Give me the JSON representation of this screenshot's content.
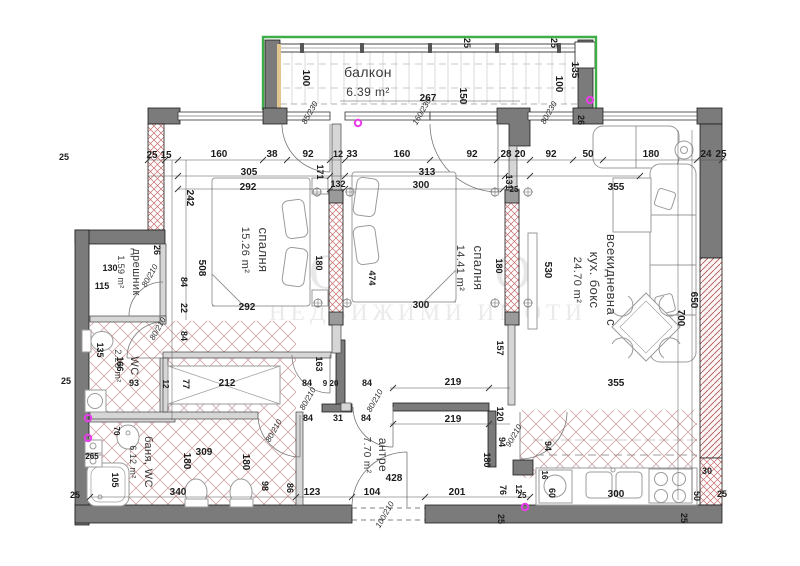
{
  "watermark": {
    "line1": "О М О",
    "line2": "НЕДВИЖИМИ ИМОТИ"
  },
  "rooms": [
    {
      "name": "балкон",
      "area": "6.39 m²"
    },
    {
      "name": "спалня",
      "area": "15.26 m²"
    },
    {
      "name": "спалня",
      "area": "14.41 m²"
    },
    {
      "name": "всекидневна с кух. бокс",
      "area": "24.70 m²"
    },
    {
      "name": "дрешник",
      "area": "1.59 m²"
    },
    {
      "name": "WC",
      "area": "2.28 m²"
    },
    {
      "name": "баня, WC",
      "area": "6.12 m²"
    },
    {
      "name": "антре",
      "area": "7.70 m²"
    }
  ],
  "colors": {
    "wall": "#7b7b7b",
    "hatch": "#c06060",
    "green": "#3fae49",
    "magenta": "#e83de8",
    "furniture": "#9b9b9b"
  },
  "magenta_dots": [
    [
      358,
      123
    ],
    [
      88,
      418
    ],
    [
      88,
      438
    ],
    [
      525,
      507
    ],
    [
      590,
      100
    ]
  ],
  "axis_markers": [
    [
      317,
      192
    ],
    [
      350,
      192
    ],
    [
      318,
      303
    ],
    [
      347,
      303
    ],
    [
      495,
      192
    ],
    [
      528,
      192
    ],
    [
      495,
      303
    ],
    [
      528,
      303
    ]
  ],
  "labels": [
    {
      "t": "балкон",
      "x": 368,
      "y": 77,
      "s": 14,
      "cls": "room"
    },
    {
      "t": "6.39 m²",
      "x": 368,
      "y": 96,
      "s": 12,
      "cls": "room"
    },
    {
      "t": "спалня",
      "x": 259,
      "y": 250,
      "r": 90,
      "s": 13,
      "cls": "room"
    },
    {
      "t": "15.26 m²",
      "x": 242,
      "y": 250,
      "r": 90,
      "s": 11,
      "cls": "room"
    },
    {
      "t": "спалня",
      "x": 474,
      "y": 268,
      "r": 90,
      "s": 13,
      "cls": "room"
    },
    {
      "t": "14.41 m²",
      "x": 457,
      "y": 268,
      "r": 90,
      "s": 11,
      "cls": "room"
    },
    {
      "t": "всекидневна с",
      "x": 607,
      "y": 280,
      "r": 90,
      "s": 13,
      "cls": "room"
    },
    {
      "t": "кух. бокс",
      "x": 590,
      "y": 280,
      "r": 90,
      "s": 13,
      "cls": "room"
    },
    {
      "t": "24.70 m²",
      "x": 574,
      "y": 280,
      "r": 90,
      "s": 11,
      "cls": "room"
    },
    {
      "t": "дрешник",
      "x": 133,
      "y": 272,
      "r": 90,
      "s": 11,
      "cls": "room"
    },
    {
      "t": "1.59 m²",
      "x": 118,
      "y": 272,
      "r": 90,
      "s": 9,
      "cls": "room"
    },
    {
      "t": "WC",
      "x": 131,
      "y": 366,
      "r": 90,
      "s": 11,
      "cls": "room"
    },
    {
      "t": "2.28 m²",
      "x": 115,
      "y": 366,
      "r": 90,
      "s": 9,
      "cls": "room"
    },
    {
      "t": "баня, WC",
      "x": 145,
      "y": 462,
      "r": 90,
      "s": 11,
      "cls": "room"
    },
    {
      "t": "6.12 m²",
      "x": 130,
      "y": 462,
      "r": 90,
      "s": 9,
      "cls": "room"
    },
    {
      "t": "антре",
      "x": 379,
      "y": 455,
      "r": 90,
      "s": 12,
      "cls": "room"
    },
    {
      "t": "7.70 m²",
      "x": 364,
      "y": 455,
      "r": 90,
      "s": 10,
      "cls": "room"
    },
    {
      "t": "25",
      "x": 152,
      "y": 158
    },
    {
      "t": "15",
      "x": 166,
      "y": 158
    },
    {
      "t": "160",
      "x": 219,
      "y": 157
    },
    {
      "t": "38",
      "x": 272,
      "y": 157
    },
    {
      "t": "92",
      "x": 308,
      "y": 157
    },
    {
      "t": "12",
      "x": 338,
      "y": 157,
      "s": 9
    },
    {
      "t": "33",
      "x": 352,
      "y": 157
    },
    {
      "t": "160",
      "x": 402,
      "y": 157
    },
    {
      "t": "92",
      "x": 472,
      "y": 157
    },
    {
      "t": "28",
      "x": 506,
      "y": 157
    },
    {
      "t": "20",
      "x": 520,
      "y": 157
    },
    {
      "t": "92",
      "x": 551,
      "y": 157
    },
    {
      "t": "50",
      "x": 588,
      "y": 157
    },
    {
      "t": "180",
      "x": 651,
      "y": 157
    },
    {
      "t": "24",
      "x": 706,
      "y": 157
    },
    {
      "t": "25",
      "x": 721,
      "y": 157
    },
    {
      "t": "305",
      "x": 249,
      "y": 175
    },
    {
      "t": "313",
      "x": 427,
      "y": 175
    },
    {
      "t": "355",
      "x": 616,
      "y": 190
    },
    {
      "t": "292",
      "x": 248,
      "y": 190
    },
    {
      "t": "300",
      "x": 421,
      "y": 188
    },
    {
      "t": "242",
      "x": 187,
      "y": 198,
      "r": 90
    },
    {
      "t": "171",
      "x": 317,
      "y": 172,
      "r": 90,
      "s": 9
    },
    {
      "t": "132",
      "x": 338,
      "y": 187,
      "s": 9
    },
    {
      "t": "131",
      "x": 506,
      "y": 182,
      "r": 90,
      "s": 9
    },
    {
      "t": "25",
      "x": 514,
      "y": 192,
      "s": 8
    },
    {
      "t": "26",
      "x": 578,
      "y": 120,
      "r": 90,
      "s": 9
    },
    {
      "t": "100",
      "x": 303,
      "y": 78,
      "r": 90
    },
    {
      "t": "100",
      "x": 556,
      "y": 84,
      "r": 90
    },
    {
      "t": "135",
      "x": 572,
      "y": 70,
      "r": 90
    },
    {
      "t": "150",
      "x": 460,
      "y": 96,
      "r": 90
    },
    {
      "t": "267",
      "x": 428,
      "y": 101
    },
    {
      "t": "25",
      "x": 464,
      "y": 43,
      "r": 90,
      "s": 9
    },
    {
      "t": "25",
      "x": 551,
      "y": 43,
      "r": 90,
      "s": 9
    },
    {
      "t": "160/230",
      "x": 424,
      "y": 113,
      "r": -60,
      "i": 1,
      "s": 8,
      "cls": "door"
    },
    {
      "t": "85/230",
      "x": 312,
      "y": 114,
      "r": -60,
      "i": 1,
      "s": 8,
      "cls": "door"
    },
    {
      "t": "80/230",
      "x": 551,
      "y": 114,
      "r": -60,
      "i": 1,
      "s": 8,
      "cls": "door"
    },
    {
      "t": "26",
      "x": 154,
      "y": 250,
      "r": 90,
      "s": 9
    },
    {
      "t": "508",
      "x": 199,
      "y": 268,
      "r": 90
    },
    {
      "t": "84",
      "x": 181,
      "y": 282,
      "r": 90,
      "s": 9
    },
    {
      "t": "22",
      "x": 181,
      "y": 308,
      "r": 90,
      "s": 9
    },
    {
      "t": "84",
      "x": 181,
      "y": 336,
      "r": 90,
      "s": 9
    },
    {
      "t": "130",
      "x": 110,
      "y": 271,
      "s": 9
    },
    {
      "t": "115",
      "x": 102,
      "y": 289,
      "s": 9
    },
    {
      "t": "80/210",
      "x": 152,
      "y": 277,
      "r": -60,
      "i": 1,
      "s": 8,
      "cls": "door"
    },
    {
      "t": "80/210",
      "x": 160,
      "y": 330,
      "r": -60,
      "i": 1,
      "s": 8,
      "cls": "door"
    },
    {
      "t": "135",
      "x": 97,
      "y": 350,
      "r": 90,
      "s": 9
    },
    {
      "t": "166",
      "x": 117,
      "y": 364,
      "r": 90,
      "s": 9
    },
    {
      "t": "93",
      "x": 134,
      "y": 386,
      "s": 9
    },
    {
      "t": "25",
      "x": 66,
      "y": 384,
      "s": 9
    },
    {
      "t": "25",
      "x": 64,
      "y": 160,
      "s": 9
    },
    {
      "t": "12",
      "x": 163,
      "y": 384,
      "r": 90,
      "s": 8
    },
    {
      "t": "77",
      "x": 183,
      "y": 384,
      "r": 90,
      "s": 9
    },
    {
      "t": "212",
      "x": 227,
      "y": 386
    },
    {
      "t": "163",
      "x": 316,
      "y": 364,
      "r": 90,
      "s": 9
    },
    {
      "t": "265",
      "x": 92,
      "y": 459,
      "s": 8
    },
    {
      "t": "70",
      "x": 114,
      "y": 431,
      "r": 90,
      "s": 8
    },
    {
      "t": "105",
      "x": 112,
      "y": 480,
      "r": 90,
      "s": 9
    },
    {
      "t": "309",
      "x": 204,
      "y": 455
    },
    {
      "t": "180",
      "x": 184,
      "y": 461,
      "r": 90
    },
    {
      "t": "180",
      "x": 243,
      "y": 462,
      "r": 90
    },
    {
      "t": "340",
      "x": 178,
      "y": 495
    },
    {
      "t": "98",
      "x": 262,
      "y": 486,
      "r": 90,
      "s": 9
    },
    {
      "t": "86",
      "x": 287,
      "y": 488,
      "r": 90,
      "s": 9
    },
    {
      "t": "25",
      "x": 75,
      "y": 498,
      "s": 9
    },
    {
      "t": "80/210",
      "x": 276,
      "y": 432,
      "r": -60,
      "i": 1,
      "s": 8,
      "cls": "door"
    },
    {
      "t": "84",
      "x": 307,
      "y": 386,
      "s": 9
    },
    {
      "t": "9",
      "x": 325,
      "y": 386,
      "s": 8
    },
    {
      "t": "20",
      "x": 334,
      "y": 386,
      "s": 8
    },
    {
      "t": "84",
      "x": 367,
      "y": 386,
      "s": 9
    },
    {
      "t": "84",
      "x": 308,
      "y": 421,
      "s": 9
    },
    {
      "t": "31",
      "x": 338,
      "y": 421,
      "s": 9
    },
    {
      "t": "84",
      "x": 366,
      "y": 421,
      "s": 9
    },
    {
      "t": "80/210",
      "x": 310,
      "y": 400,
      "r": -60,
      "i": 1,
      "s": 8,
      "cls": "door"
    },
    {
      "t": "80/210",
      "x": 377,
      "y": 402,
      "r": -60,
      "i": 1,
      "s": 8,
      "cls": "door"
    },
    {
      "t": "219",
      "x": 453,
      "y": 385
    },
    {
      "t": "219",
      "x": 453,
      "y": 422
    },
    {
      "t": "123",
      "x": 312,
      "y": 495
    },
    {
      "t": "104",
      "x": 372,
      "y": 495
    },
    {
      "t": "428",
      "x": 394,
      "y": 481
    },
    {
      "t": "201",
      "x": 457,
      "y": 495
    },
    {
      "t": "100/210",
      "x": 387,
      "y": 516,
      "r": -60,
      "i": 1,
      "s": 8,
      "cls": "door"
    },
    {
      "t": "120",
      "x": 497,
      "y": 414,
      "r": 90,
      "s": 9
    },
    {
      "t": "94",
      "x": 499,
      "y": 442,
      "r": 90,
      "s": 9
    },
    {
      "t": "90/210",
      "x": 516,
      "y": 437,
      "r": -60,
      "i": 1,
      "s": 8,
      "cls": "door"
    },
    {
      "t": "180",
      "x": 484,
      "y": 460,
      "r": 90,
      "s": 9
    },
    {
      "t": "76",
      "x": 500,
      "y": 490,
      "r": 90,
      "s": 9
    },
    {
      "t": "12",
      "x": 516,
      "y": 489,
      "r": 90,
      "s": 8
    },
    {
      "t": "25",
      "x": 522,
      "y": 498,
      "s": 8
    },
    {
      "t": "292",
      "x": 247,
      "y": 310
    },
    {
      "t": "300",
      "x": 421,
      "y": 308
    },
    {
      "t": "474",
      "x": 369,
      "y": 278,
      "r": 90,
      "s": 9
    },
    {
      "t": "180",
      "x": 316,
      "y": 263,
      "r": 90,
      "s": 9
    },
    {
      "t": "180",
      "x": 496,
      "y": 266,
      "r": 90,
      "s": 9
    },
    {
      "t": "157",
      "x": 497,
      "y": 348,
      "r": 90,
      "s": 9
    },
    {
      "t": "530",
      "x": 545,
      "y": 270,
      "r": 90
    },
    {
      "t": "650",
      "x": 691,
      "y": 300,
      "r": 90
    },
    {
      "t": "700",
      "x": 678,
      "y": 318,
      "r": 90
    },
    {
      "t": "355",
      "x": 616,
      "y": 386
    },
    {
      "t": "16",
      "x": 542,
      "y": 475,
      "r": 90,
      "s": 8
    },
    {
      "t": "60",
      "x": 549,
      "y": 493,
      "r": 90,
      "s": 9
    },
    {
      "t": "94",
      "x": 545,
      "y": 446,
      "r": 90,
      "s": 9
    },
    {
      "t": "300",
      "x": 616,
      "y": 497
    },
    {
      "t": "30",
      "x": 707,
      "y": 474,
      "s": 9
    },
    {
      "t": "50",
      "x": 694,
      "y": 496,
      "r": 90,
      "s": 9
    },
    {
      "t": "25",
      "x": 722,
      "y": 497,
      "s": 9
    },
    {
      "t": "25",
      "x": 681,
      "y": 518,
      "r": 90,
      "s": 9
    },
    {
      "t": "25",
      "x": 498,
      "y": 519,
      "r": 90,
      "s": 9
    }
  ]
}
